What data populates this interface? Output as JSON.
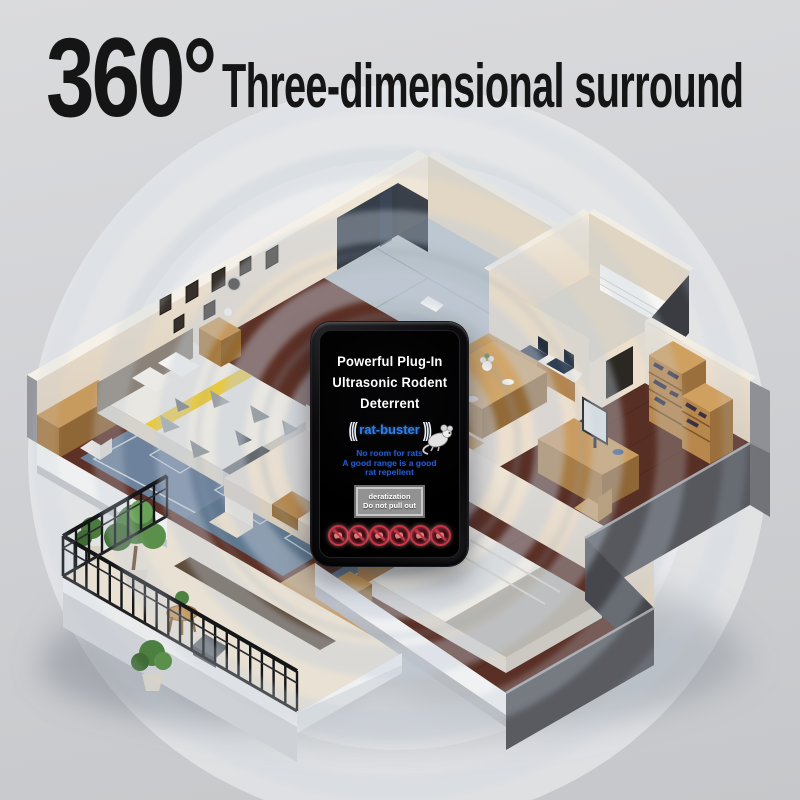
{
  "title": {
    "big": "360°",
    "rest": "Three-dimensional surround"
  },
  "device": {
    "heading": [
      "Powerful Plug-In",
      "Ultrasonic Rodent",
      "Deterrent"
    ],
    "brand": {
      "left_waves": "(((",
      "name": "rat-buster",
      "right_waves": ")))"
    },
    "mouse_icon": "mouse-cartoon-icon",
    "tagline": [
      "No room for rats",
      "A good range is a good",
      "rat repellent"
    ],
    "label_box": [
      "deratization",
      "Do not pull out"
    ],
    "pest_icons": [
      "no-pest-icon",
      "no-pest-icon",
      "no-pest-icon",
      "no-pest-icon",
      "no-pest-icon",
      "no-pest-icon"
    ],
    "colors": {
      "brand_blue": "#2e7fe8",
      "tagline_blue": "#2759c4",
      "alert_red": "#cc3344",
      "body_black": "#0b0b0d",
      "label_gray": "#929292"
    }
  },
  "scene": {
    "type": "isometric-apartment-cutaway-with-ultrasonic-wave-rings",
    "rooms": [
      "master-bedroom",
      "bathroom",
      "kitchen",
      "dining-area",
      "study",
      "living-room",
      "second-bedroom",
      "balcony"
    ],
    "colors": {
      "background_gray": "#d2d4d7",
      "halo_white": "#f2f4f5",
      "wall_cream": "#ece2d2",
      "outer_wall_gray": "#56585e",
      "floor_wood_dark": "#5d3126",
      "floor_wood_light": "#c59d67",
      "rug_blue": "#64788e",
      "wave_ring": "#b9c3d2",
      "railing_black": "#141517",
      "plant_green": "#4d7f41"
    }
  }
}
